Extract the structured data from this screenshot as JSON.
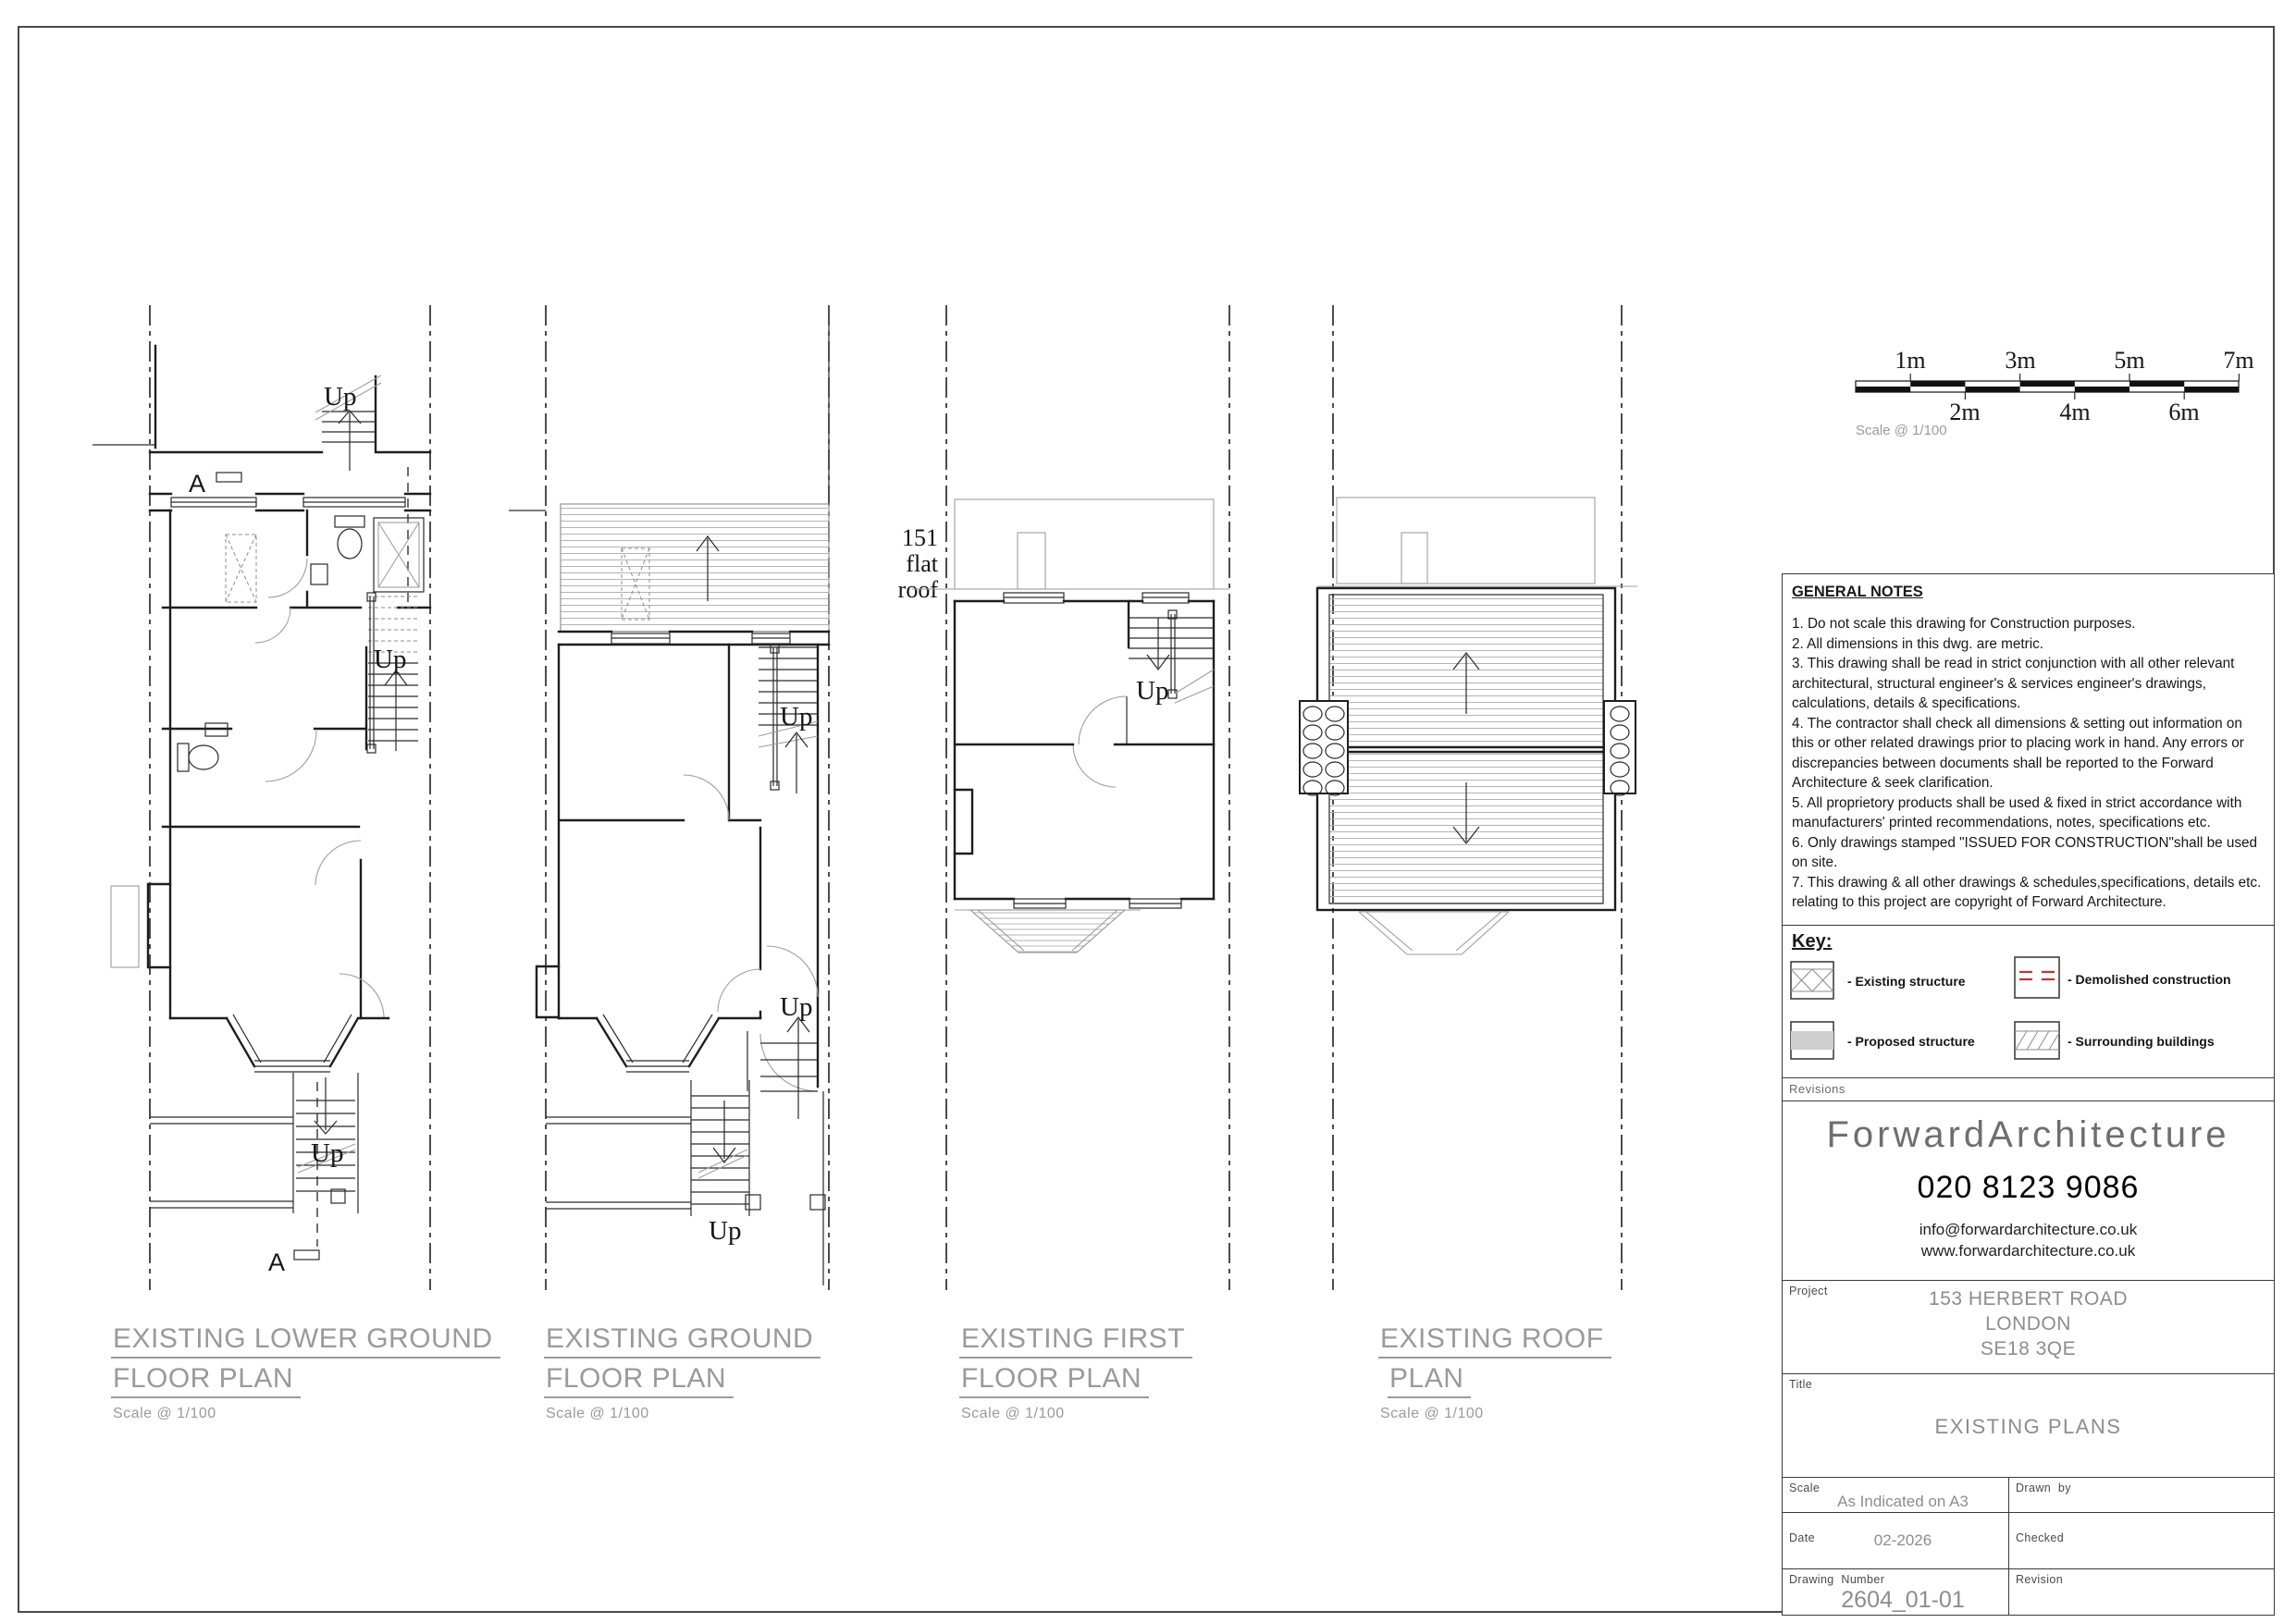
{
  "scale_bar": {
    "top_labels": [
      "1m",
      "3m",
      "5m",
      "7m"
    ],
    "bottom_labels": [
      "2m",
      "4m",
      "6m"
    ],
    "note": "Scale @ 1/100"
  },
  "annotations": {
    "up": "Up",
    "section": "A",
    "neighbour_line1": "151",
    "neighbour_line2": "flat",
    "neighbour_line3": "roof"
  },
  "plan_titles": [
    {
      "line1": "EXISTING LOWER GROUND",
      "line2": "FLOOR PLAN",
      "scale": "Scale @ 1/100"
    },
    {
      "line1": "EXISTING GROUND",
      "line2": "FLOOR PLAN",
      "scale": "Scale @ 1/100"
    },
    {
      "line1": "EXISTING FIRST",
      "line2": "FLOOR PLAN",
      "scale": "Scale @ 1/100"
    },
    {
      "line1": "EXISTING ROOF",
      "line2": "PLAN",
      "scale": "Scale @ 1/100"
    }
  ],
  "general_notes": {
    "heading": "GENERAL NOTES",
    "items": [
      "1. Do not scale this drawing for Construction purposes.",
      "2. All dimensions in this dwg. are metric.",
      "3. This drawing shall be read in strict conjunction with all other relevant architectural, structural engineer's & services engineer's drawings, calculations, details & specifications.",
      "4. The contractor shall check all dimensions & setting out information on this or other related drawings prior to placing work in hand. Any errors or discrepancies between documents shall be reported to the Forward Architecture & seek clarification.",
      "5. All proprietory products shall be used & fixed in strict accordance with manufacturers' printed recommendations, notes, specifications etc.",
      "6. Only drawings stamped \"ISSUED FOR CONSTRUCTION\"shall be used on site.",
      "7. This drawing & all other drawings & schedules,specifications, details etc. relating to this project are copyright of Forward Architecture."
    ]
  },
  "key": {
    "heading": "Key:",
    "existing": "- Existing structure",
    "demolished": "- Demolished construction",
    "proposed": "- Proposed structure",
    "surrounding": "- Surrounding buildings"
  },
  "revisions_label": "Revisions",
  "company": {
    "logo": "ForwardArchitecture",
    "phone": "020 8123 9086",
    "email": "info@forwardarchitecture.co.uk",
    "website": "www.forwardarchitecture.co.uk"
  },
  "fields": {
    "project_label": "Project",
    "project_line1": "153 HERBERT ROAD",
    "project_line2": "LONDON",
    "project_line3": "SE18 3QE",
    "title_label": "Title",
    "title_value": "EXISTING PLANS",
    "scale_label": "Scale",
    "scale_value": "As Indicated on A3",
    "drawn_label": "Drawn  by",
    "date_label": "Date",
    "date_value": "02-2026",
    "checked_label": "Checked",
    "number_label": "Drawing  Number",
    "number_value": "2604_01-01",
    "revision_label": "Revision"
  },
  "colors": {
    "demolished_red": "#c23434",
    "line": "#1e1e1e",
    "light_gray": "#9e9e9e",
    "caption_gray": "#9a9a9a"
  }
}
